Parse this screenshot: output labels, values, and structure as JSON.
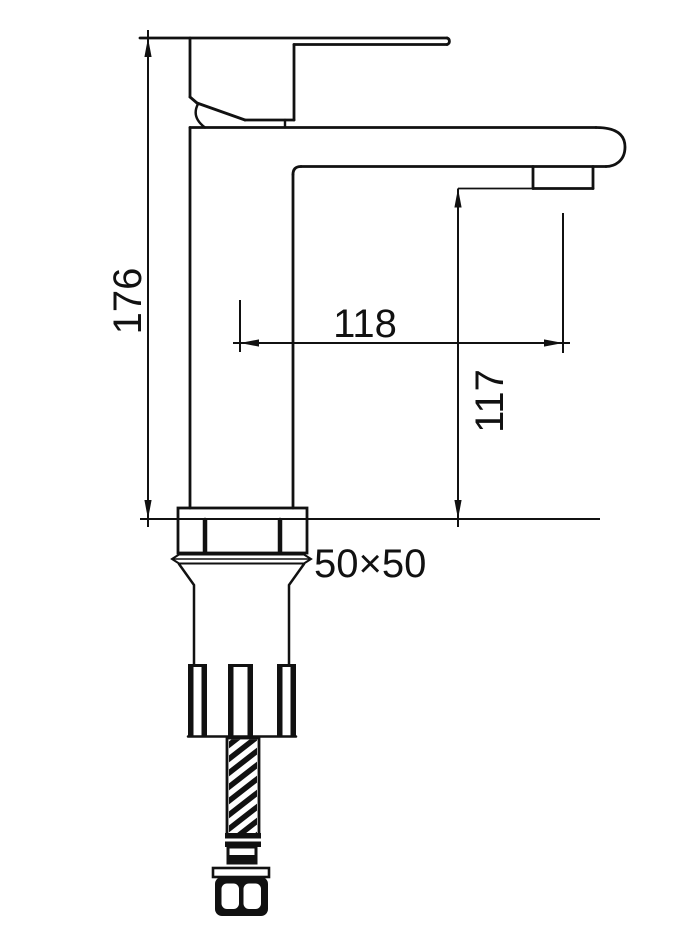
{
  "drawing": {
    "subject": "single-lever basin faucet side-view technical line drawing with flexible supply hose",
    "background_color": "#ffffff",
    "line_color": "#111111",
    "labels": {
      "overall_height": "176",
      "spout_reach": "118",
      "outlet_height": "117",
      "base_size": "50×50"
    }
  }
}
